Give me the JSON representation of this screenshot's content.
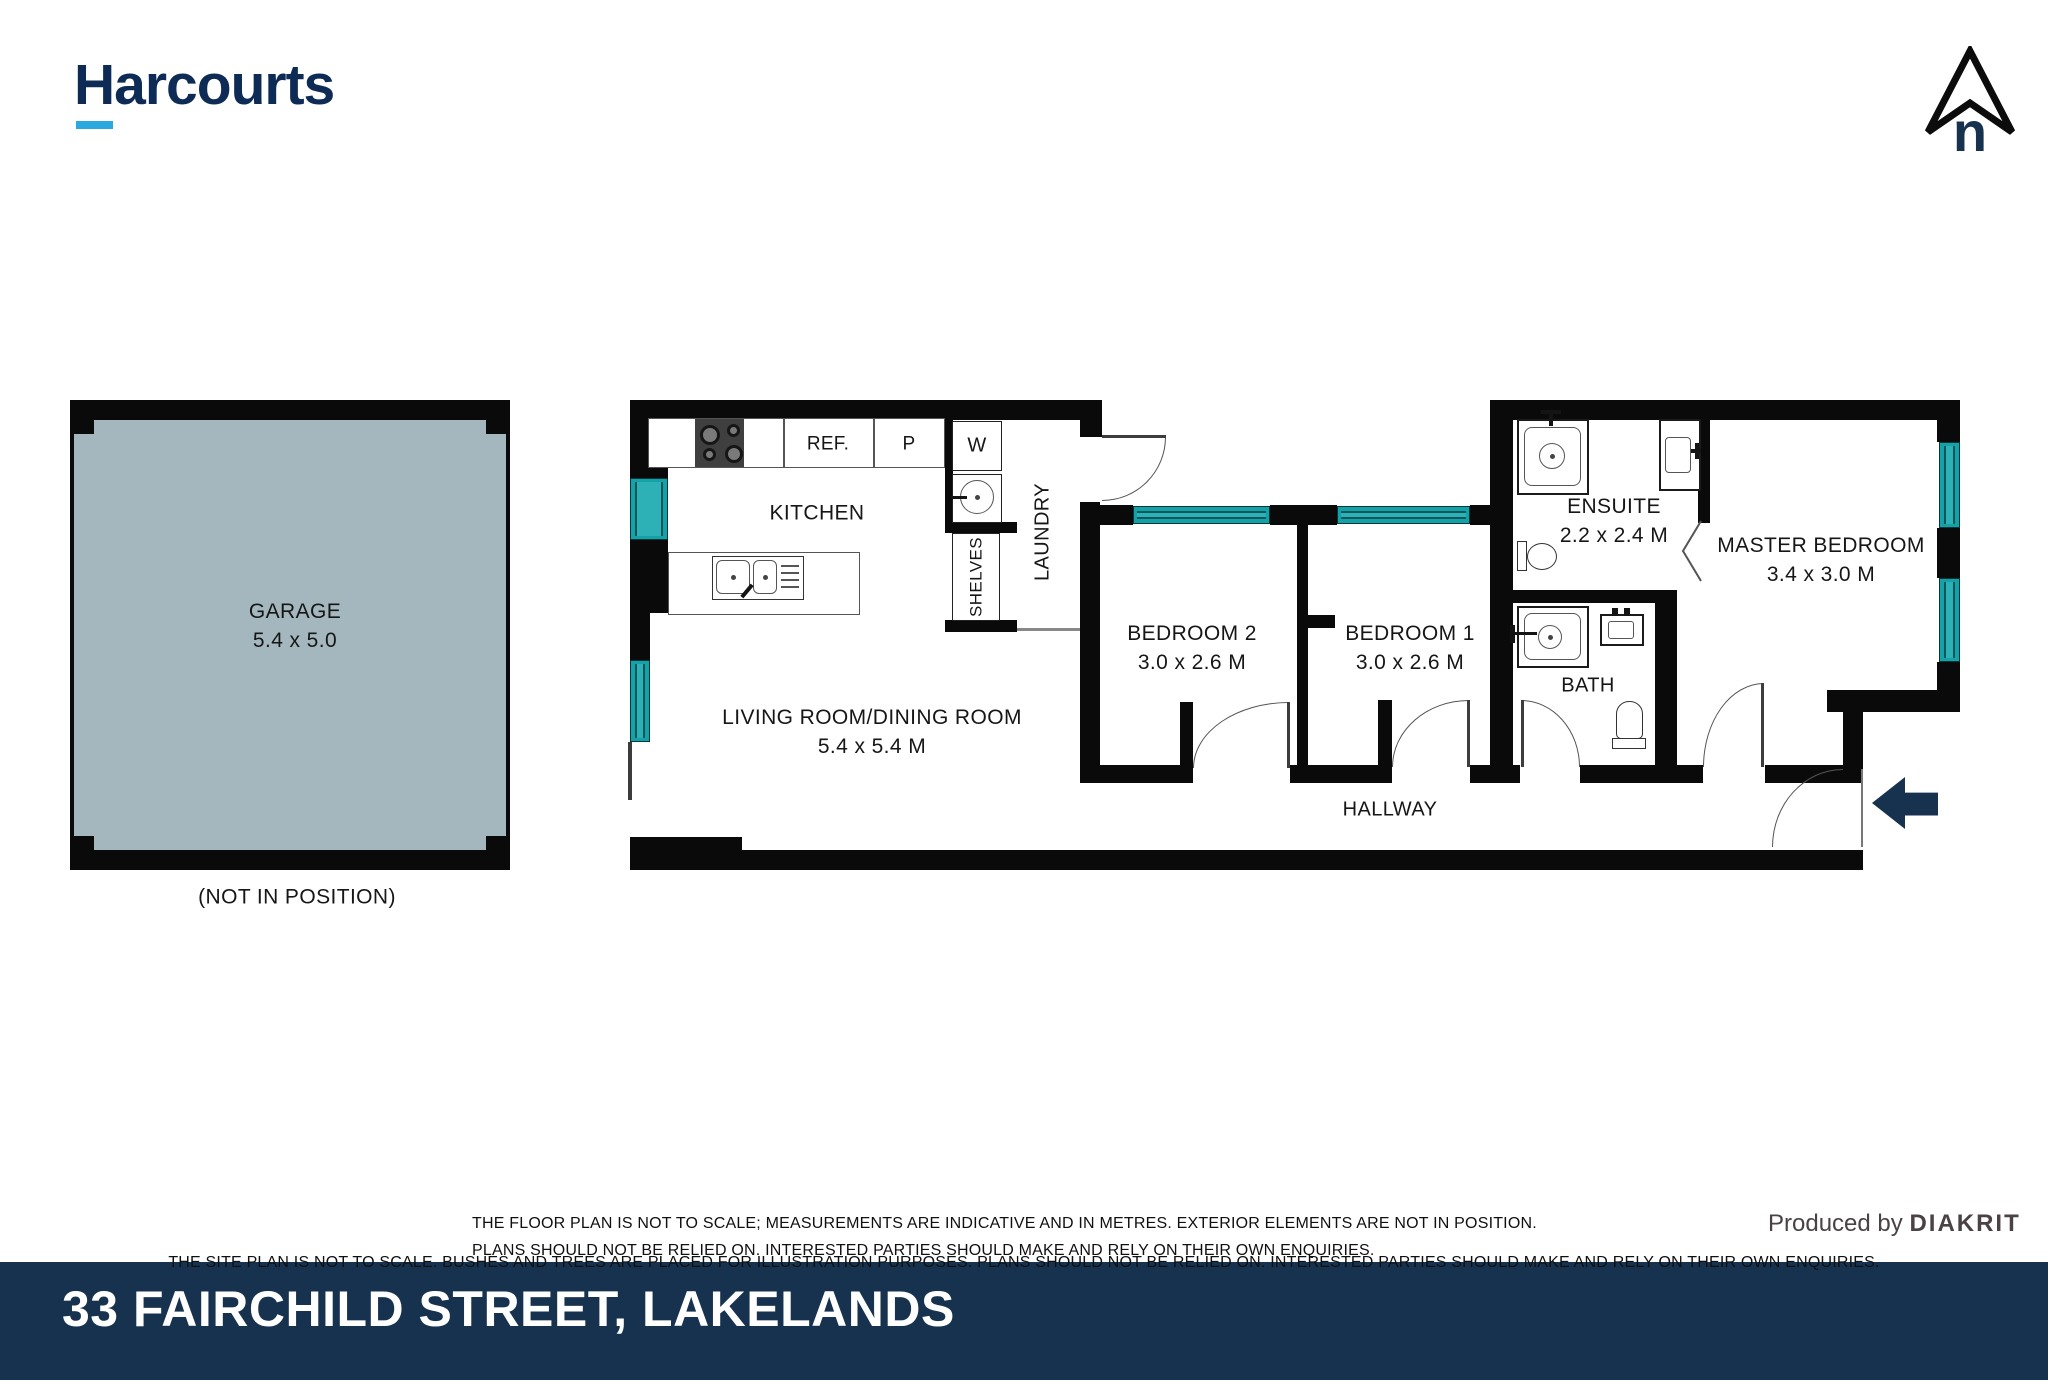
{
  "brand": {
    "logo_text": "Harcourts"
  },
  "north_indicator": {
    "label": "n"
  },
  "garage": {
    "label": "GARAGE",
    "dims": "5.4 x 5.0",
    "note": "(NOT IN POSITION)"
  },
  "rooms": {
    "kitchen": {
      "label": "KITCHEN"
    },
    "living": {
      "label": "LIVING ROOM/DINING ROOM",
      "dims": "5.4 x 5.4 M"
    },
    "laundry": {
      "label": "LAUNDRY"
    },
    "bedroom2": {
      "label": "BEDROOM 2",
      "dims": "3.0 x 2.6 M"
    },
    "bedroom1": {
      "label": "BEDROOM 1",
      "dims": "3.0 x 2.6 M"
    },
    "ensuite": {
      "label": "ENSUITE",
      "dims": "2.2 x 2.4 M"
    },
    "bath": {
      "label": "BATH"
    },
    "master": {
      "label": "MASTER BEDROOM",
      "dims": "3.4 x 3.0 M"
    },
    "hallway": {
      "label": "HALLWAY"
    }
  },
  "fixtures": {
    "fridge": "REF.",
    "pantry": "P",
    "washer": "W",
    "shelves": "SHELVES"
  },
  "footer": {
    "disclaimer_line1": "THE FLOOR PLAN IS NOT TO SCALE; MEASUREMENTS ARE INDICATIVE AND IN METRES. EXTERIOR ELEMENTS ARE NOT IN POSITION.",
    "disclaimer_line2": "PLANS SHOULD NOT BE RELIED ON. INTERESTED PARTIES SHOULD MAKE AND RELY ON THEIR OWN ENQUIRIES.",
    "disclaimer_line3": "THE SITE PLAN IS NOT TO SCALE. BUSHES AND TREES ARE PLACED FOR ILLUSTRATION PURPOSES. PLANS SHOULD NOT BE RELIED ON. INTERESTED PARTIES SHOULD MAKE AND RELY ON THEIR OWN ENQUIRIES.",
    "produced_by": "Produced by",
    "producer": "DIAKRIT",
    "address": "33 FAIRCHILD STREET, LAKELANDS"
  },
  "colors": {
    "wall": "#0a0a0a",
    "window_teal": "#12a2a8",
    "garage_fill": "#a4b7be",
    "navy": "#16324f",
    "logo_navy": "#0d2b55",
    "accent_blue": "#2aa9e0"
  }
}
